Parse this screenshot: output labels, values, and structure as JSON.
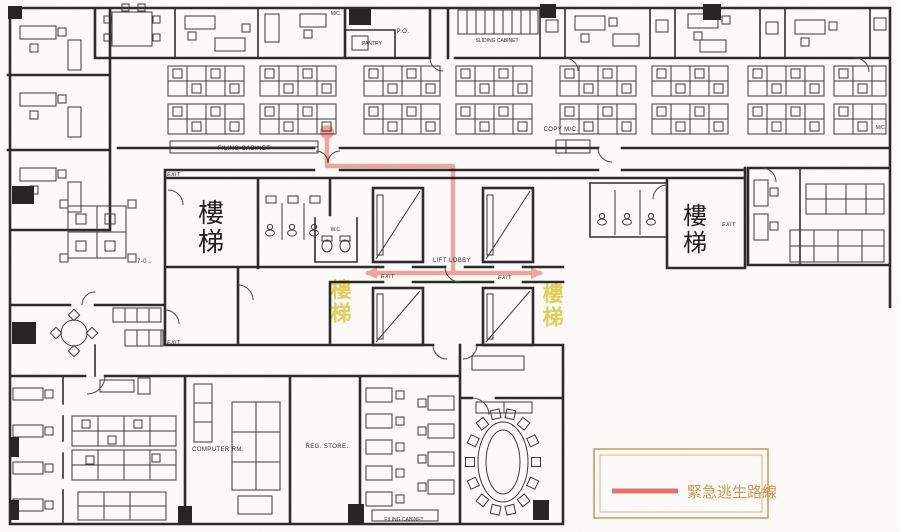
{
  "plan": {
    "labels": {
      "exit": "EXIT",
      "filing_cabinet": "FILING CABINET",
      "filing_cabinet_bottom": "FILING CABINET",
      "po": "P.O.",
      "pantry": "PANTRY",
      "sliding_cabinet": "SLIDING CABINET",
      "copy_machine": "COPY M/C.",
      "machine": "M/C.",
      "lift_lobby": "LIFT LOBBY",
      "wc": "W.C.",
      "room_7_0": "7-0→",
      "computer_room": "COMPUTER RM.",
      "reg_store": "REG. STORE."
    },
    "stairs": {
      "left": "樓梯",
      "right": "樓梯",
      "yellow_left": "樓梯",
      "yellow_right": "樓梯"
    },
    "colors": {
      "wall": "#2b2a28",
      "yellow_text": "#dfc832"
    }
  },
  "route": {
    "color": "#ef8d88",
    "path_points": "327,132 327,166 453,166 453,273",
    "lobby_points": "368,273 540,273",
    "start_dot": {
      "x": 327,
      "y": 132
    }
  },
  "legend": {
    "label": "緊急逃生路線",
    "line_color": "#e4736d",
    "frame_color": "#cf9044",
    "text_color": "#cf9044"
  }
}
